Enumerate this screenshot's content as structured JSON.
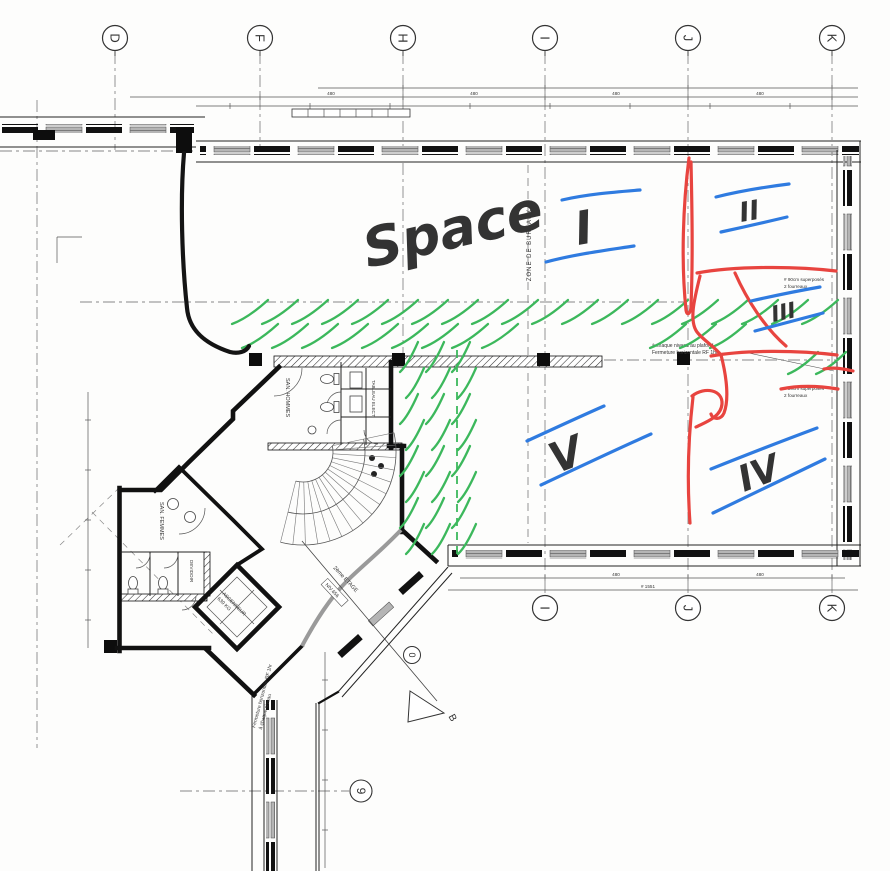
{
  "colors": {
    "blue": "#2f7be0",
    "red": "#e8443f",
    "green": "#3cb85c",
    "ink": "#1a1a1a"
  },
  "grid": {
    "top": [
      {
        "label": "D"
      },
      {
        "label": "F"
      },
      {
        "label": "H"
      },
      {
        "label": "I"
      },
      {
        "label": "J"
      },
      {
        "label": "K"
      }
    ],
    "bottom": [
      {
        "label": "I"
      },
      {
        "label": "J"
      },
      {
        "label": "K"
      }
    ],
    "side": {
      "nine": "9",
      "zero": "0",
      "section": "B"
    }
  },
  "labels": {
    "zone": "ZONE DE BUREAUX",
    "san_hommes": "SAN. HOMMES",
    "san_femmes": "SAN. FEMMES",
    "devidoir": "DEVIDOIR",
    "ascenseur_1": "ASCENSEUR",
    "ascenseur_2": "630 KG",
    "tableau": "TABLEAU ELECT.",
    "etage": "2ème ETAGE",
    "niveau": "NIV.656"
  },
  "notes": {
    "ceiling_1": "à chaque niveau au plafond",
    "ceiling_2": "Fermeture horizontale RF 1hr",
    "sleeves_1": "# 90cm superposés",
    "sleeves_2": "2 fourreaux",
    "corridor_1": "Fermeture horizontale RF 1hr",
    "corridor_2": "à chaque niveau"
  },
  "handwriting": {
    "space_word": "Space",
    "space_num": "I",
    "zone2": "II",
    "zone3": "III",
    "zone4": "IV",
    "zone5": "V"
  },
  "dims": {
    "a": "480",
    "b": "480",
    "c": "480",
    "d": "480",
    "e": "# 1551",
    "f": "480",
    "g": "480"
  }
}
